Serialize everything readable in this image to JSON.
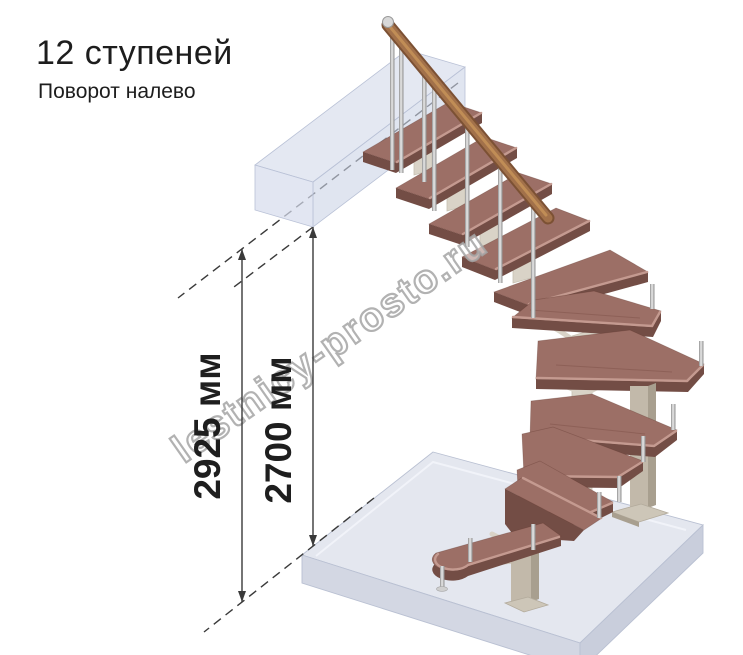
{
  "header": {
    "title": "12 ступеней",
    "subtitle": "Поворот налево"
  },
  "dimensions": {
    "overall_height": "2925 мм",
    "landing_height": "2700 мм"
  },
  "watermark": "lestnicy-prosto.ru",
  "diagram": {
    "type": "isometric staircase drawing",
    "steps_count": 12,
    "turn_direction": "налево"
  },
  "colors": {
    "text": "#1d1d1d",
    "dim": "#3a3a3a",
    "wood-top": "#9c6f66",
    "wood-side": "#734d45",
    "wood-edge": "#c49a90",
    "rail": "#a2714a",
    "rail-dark": "#7c5134",
    "rail-light": "#c59258",
    "frame": "#d9d3c7",
    "column": "#c2b9aa",
    "column-side": "#a89f8f",
    "floor-top": "#e4e7ef",
    "floor-left": "#d3d7e3",
    "floor-right": "#c9cedc",
    "landing-top": "#dfe4f0",
    "landing-front": "#ccd3e6",
    "landing-side": "#d6dcec",
    "watermark-stroke": "#a5a5a5"
  }
}
